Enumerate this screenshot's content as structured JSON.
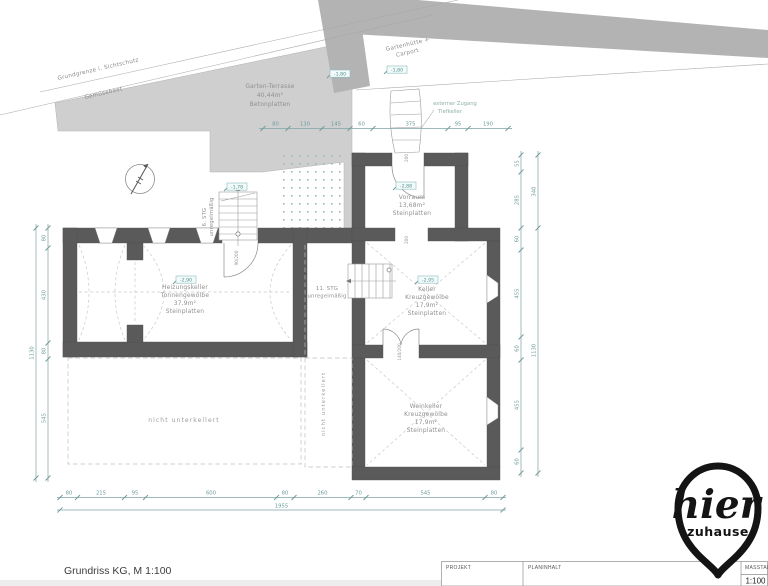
{
  "site": {
    "boundary_label": "Grundgrenze i. Sichtschutz",
    "garden_bed_label": "Gemüsebeet",
    "terrace_name": "Garten-Terrasse",
    "terrace_area": "40,44m²",
    "terrace_floor": "Betonplatten",
    "carport_label_line1": "Gartenhütte +",
    "carport_label_line2": "Carport",
    "external_access_line1": "externer Zugang",
    "external_access_line2": "Tiefkeller"
  },
  "rooms": {
    "vorraum": {
      "name": "Vorraum",
      "area": "13,68m²",
      "floor": "Steinplatten",
      "level": "-2,88"
    },
    "heizungskeller": {
      "name": "Heizungskeller",
      "vault": "Tonnengewölbe",
      "area": "37,9m²",
      "floor": "Steinplatten",
      "level": "-2,90"
    },
    "keller": {
      "name": "Keller",
      "vault": "Kreuzgewölbe",
      "area": "17,9m²",
      "floor": "Steinplatten",
      "level": "-2,95"
    },
    "weinkeller": {
      "name": "Weinkeller",
      "vault": "Kreuzgewölbe",
      "area": "17,9m²",
      "floor": "Steinplatten"
    }
  },
  "stairs": {
    "upper": {
      "label": "6. STG",
      "note": "unregelmäßig"
    },
    "lower": {
      "label": "11. STG",
      "note": "unregelmäßig"
    }
  },
  "annotations": {
    "not_excavated": "nicht unterkellert",
    "not_excavated_vertical": "nicht unterkellert"
  },
  "levels": {
    "stair_top": "-1,78",
    "carport_left": "-1,80",
    "carport_right": "-1,80"
  },
  "doors": {
    "entrance": "200",
    "vorraum_exit": "200",
    "heizung": "90/200",
    "wein": "140/200"
  },
  "dimensions": {
    "top": [
      "80",
      "130",
      "145",
      "60",
      "375",
      "95",
      "190"
    ],
    "bottom": [
      "80",
      "215",
      "95",
      "600",
      "80",
      "260",
      "70",
      "545",
      "80"
    ],
    "bottom_total": "1955",
    "left": [
      "80",
      "430",
      "80",
      "545"
    ],
    "left_total": "1130",
    "right": [
      "55",
      "285",
      "60",
      "455",
      "60",
      "455",
      "60"
    ],
    "right_upper_total": "340",
    "right_total": "1130"
  },
  "titleblock": {
    "project_label": "PROJEKT",
    "content_label": "PLANINHALT",
    "scale_label": "MASSTAB",
    "scale_value": "1:100"
  },
  "footer": {
    "drawing_title": "Grundriss KG, M 1:100"
  },
  "logo": {
    "word1": "hier",
    "word2": "zuhause"
  },
  "colors": {
    "wall": "#5a5a5a",
    "terrace": "#cfcfcf",
    "carport_band": "#b3b3b3",
    "dimension": "#7fa3a3",
    "room_label": "#8f8f8f",
    "level_label": "#4f9090"
  }
}
